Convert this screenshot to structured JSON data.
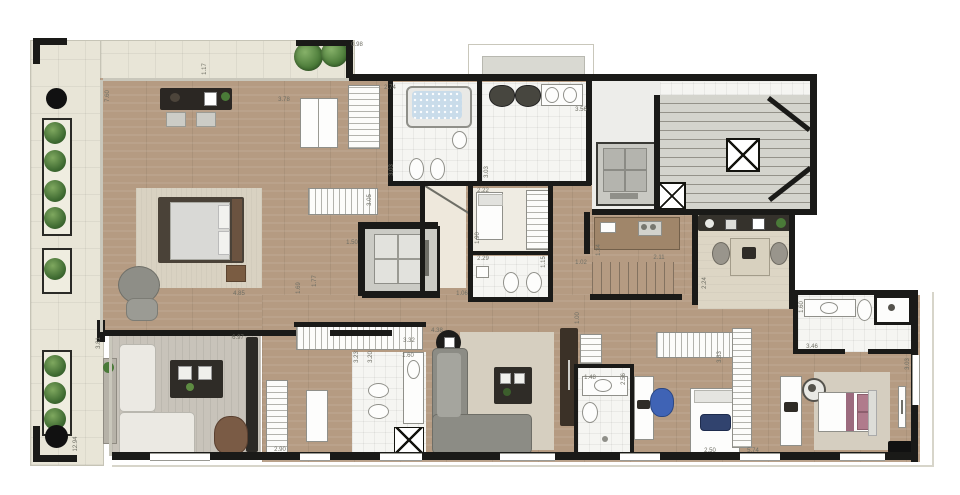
{
  "plan": {
    "kind": "residential floor plan (penthouse upper level with wrap-around terrace)",
    "dimension_unit": "m",
    "dimension_labels": [
      {
        "value": "0.98",
        "x": 357,
        "y": 45,
        "rot": 0
      },
      {
        "value": "1.17",
        "x": 205,
        "y": 69,
        "rot": 1
      },
      {
        "value": "7.60",
        "x": 108,
        "y": 96,
        "rot": 1
      },
      {
        "value": "3.78",
        "x": 284,
        "y": 100,
        "rot": 0
      },
      {
        "value": "2.74",
        "x": 390,
        "y": 88,
        "rot": 0
      },
      {
        "value": "3.03",
        "x": 392,
        "y": 170,
        "rot": 1
      },
      {
        "value": "3.56",
        "x": 581,
        "y": 110,
        "rot": 0
      },
      {
        "value": "3.03",
        "x": 487,
        "y": 172,
        "rot": 1
      },
      {
        "value": "3.05",
        "x": 370,
        "y": 200,
        "rot": 1
      },
      {
        "value": "2.22",
        "x": 483,
        "y": 191,
        "rot": 0
      },
      {
        "value": "1.90",
        "x": 478,
        "y": 238,
        "rot": 1
      },
      {
        "value": "2.29",
        "x": 483,
        "y": 259,
        "rot": 0
      },
      {
        "value": "1.15",
        "x": 544,
        "y": 262,
        "rot": 1
      },
      {
        "value": "1.50",
        "x": 352,
        "y": 243,
        "rot": 0
      },
      {
        "value": "1.69",
        "x": 299,
        "y": 288,
        "rot": 1
      },
      {
        "value": "1.77",
        "x": 315,
        "y": 281,
        "rot": 1
      },
      {
        "value": "1.06",
        "x": 462,
        "y": 294,
        "rot": 0
      },
      {
        "value": "4.85",
        "x": 239,
        "y": 294,
        "rot": 0
      },
      {
        "value": "3.81",
        "x": 99,
        "y": 343,
        "rot": 1
      },
      {
        "value": "6.97",
        "x": 238,
        "y": 338,
        "rot": 0
      },
      {
        "value": "12.94",
        "x": 76,
        "y": 444,
        "rot": 1
      },
      {
        "value": "2.90",
        "x": 280,
        "y": 450,
        "rot": 0
      },
      {
        "value": "3.32",
        "x": 409,
        "y": 341,
        "rot": 0
      },
      {
        "value": "3.23",
        "x": 357,
        "y": 357,
        "rot": 1
      },
      {
        "value": "3.20",
        "x": 371,
        "y": 357,
        "rot": 1
      },
      {
        "value": "1.60",
        "x": 408,
        "y": 356,
        "rot": 0
      },
      {
        "value": "4.38",
        "x": 437,
        "y": 331,
        "rot": 0
      },
      {
        "value": "1.00",
        "x": 578,
        "y": 318,
        "rot": 1
      },
      {
        "value": "1.34",
        "x": 599,
        "y": 250,
        "rot": 1
      },
      {
        "value": "1.02",
        "x": 581,
        "y": 263,
        "rot": 0
      },
      {
        "value": "2.11",
        "x": 659,
        "y": 258,
        "rot": 0
      },
      {
        "value": "2.24",
        "x": 705,
        "y": 283,
        "rot": 1
      },
      {
        "value": "3.83",
        "x": 720,
        "y": 357,
        "rot": 1
      },
      {
        "value": "1.48",
        "x": 590,
        "y": 378,
        "rot": 0
      },
      {
        "value": "2.56",
        "x": 624,
        "y": 379,
        "rot": 1
      },
      {
        "value": "2.50",
        "x": 710,
        "y": 451,
        "rot": 0
      },
      {
        "value": "5.74",
        "x": 753,
        "y": 451,
        "rot": 0
      },
      {
        "value": "1.60",
        "x": 802,
        "y": 307,
        "rot": 1
      },
      {
        "value": "3.46",
        "x": 812,
        "y": 347,
        "rot": 0
      },
      {
        "value": "3.03",
        "x": 908,
        "y": 364,
        "rot": 1
      }
    ]
  },
  "palette": {
    "wall": "#1a1a18",
    "wood_floor": "#b59b82",
    "terrace_tile": "#e8e5d7",
    "bathroom_tile": "#f5f5f2",
    "concrete": "#d4d4cd",
    "rug": "#d9d2c2",
    "plant_green": "#4a7a38",
    "water_blue": "#c9dcea",
    "accent_chair_blue": "#3f63b5",
    "accent_bed_pink": "#b07b8c"
  },
  "icons": {
    "decor_shelf": [
      "vase-icon",
      "tools-icon",
      "picture-icon",
      "plant-icon"
    ]
  }
}
